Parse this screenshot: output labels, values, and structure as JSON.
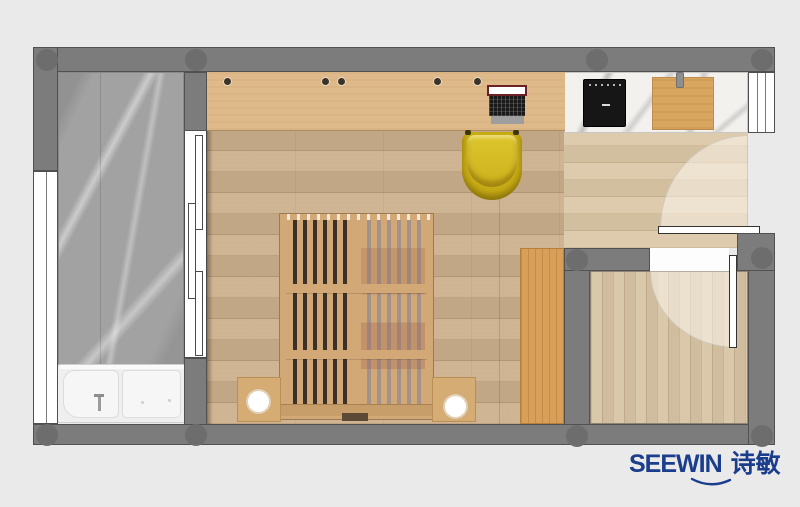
{
  "brand": {
    "logo_text": "SEEWIN",
    "logo_cjk": "诗敏",
    "logo_color": "#1a3e8c"
  },
  "palette": {
    "background": "#eaeaea",
    "wall": "#7c7c7c",
    "wall_outline": "#515151",
    "bathroom_marble": "#a2a2a2",
    "counter_marble": "#f2f1ee",
    "main_wood_floor": "#ccb08d",
    "kitchen_wood_floor": "#dbc7a7",
    "balcony_wood_floor": "#d8c5a5",
    "desk_wood": "#deba8a",
    "wardrobe_wood": "#d89f58",
    "bed_frame_wood": "#d2a877",
    "chair_yellow": "#d0b61e",
    "cooktop_black": "#161616",
    "fixture_white": "#efefef",
    "door_leaf_white": "#ffffff"
  },
  "legend": {
    "rooms": [
      {
        "id": "bathroom",
        "label": "bathroom with marble floor and walk-in tub"
      },
      {
        "id": "main-room",
        "label": "main room with desk, bed and wardrobe"
      },
      {
        "id": "kitchen",
        "label": "kitchen strip with marble counter and cooktop"
      },
      {
        "id": "balcony-room",
        "label": "small room with swing door"
      }
    ],
    "furniture": [
      {
        "id": "desk",
        "label": "wall-length wooden desk with laptop"
      },
      {
        "id": "chair",
        "label": "yellow bucket chair"
      },
      {
        "id": "bed",
        "label": "slatted wooden platform bed"
      },
      {
        "id": "nightstands",
        "label": "two wooden nightstands with round white lamps"
      },
      {
        "id": "wardrobe",
        "label": "tall orange-wood wardrobe"
      },
      {
        "id": "bathtub",
        "label": "white shower / tub combo with faucet"
      },
      {
        "id": "cooktop",
        "label": "black induction cooktop"
      },
      {
        "id": "counter-cabinet",
        "label": "wooden cabinet on counter"
      },
      {
        "id": "sliding-door",
        "label": "three-panel sliding bathroom door"
      },
      {
        "id": "swing-doors",
        "label": "two hinged doors with swing arcs"
      }
    ]
  }
}
